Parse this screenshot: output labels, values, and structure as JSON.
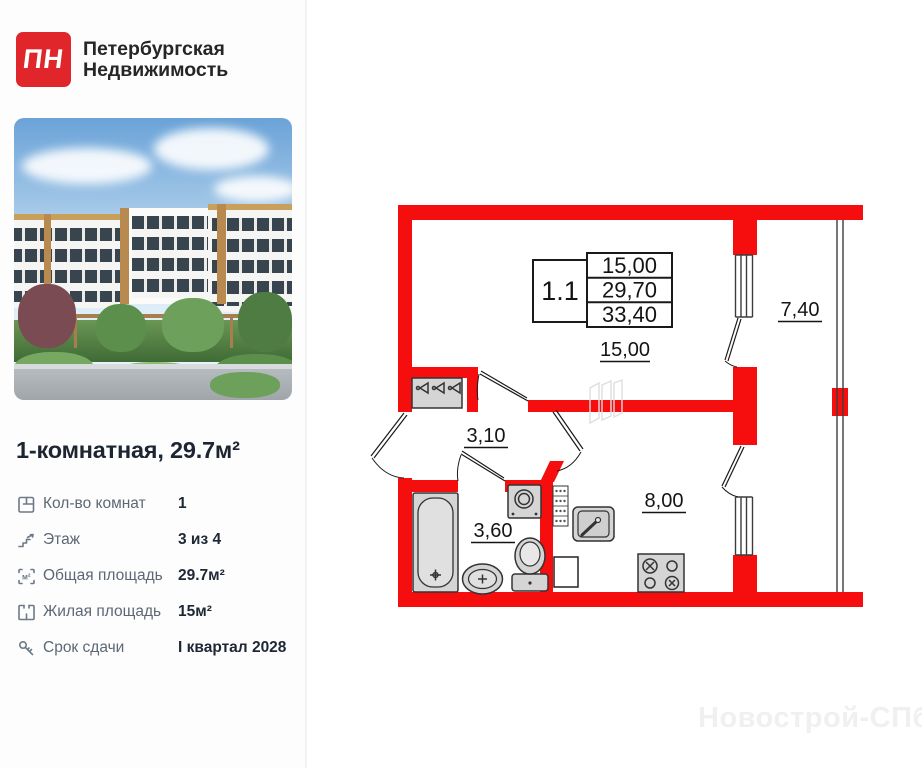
{
  "brand": {
    "logo_text": "ПН",
    "name_line1": "Петербургская",
    "name_line2": "Недвижимость"
  },
  "listing": {
    "title": "1-комнатная, 29.7м²",
    "details": [
      {
        "icon": "room-count-icon",
        "label": "Кол-во комнат",
        "value": "1"
      },
      {
        "icon": "floor-icon",
        "label": "Этаж",
        "value": "3 из 4"
      },
      {
        "icon": "total-area-icon",
        "label": "Общая площадь",
        "value": "29.7м²"
      },
      {
        "icon": "living-area-icon",
        "label": "Жилая площадь",
        "value": "15м²"
      },
      {
        "icon": "key-icon",
        "label": "Срок сдачи",
        "value": "I квартал 2028"
      }
    ]
  },
  "icons": {
    "area_unit": "м²"
  },
  "floor_plan": {
    "unit_number": "1.1",
    "spec_rows": [
      "15,00",
      "29,70",
      "33,40"
    ],
    "rooms": [
      {
        "name": "living-room",
        "area": "15,00"
      },
      {
        "name": "hallway",
        "area": "3,10"
      },
      {
        "name": "bathroom",
        "area": "3,60"
      },
      {
        "name": "kitchen",
        "area": "8,00"
      },
      {
        "name": "balcony",
        "area": "7,40"
      }
    ],
    "colors": {
      "wall": "#f60d0d",
      "fixture_fill": "#d5d5d5",
      "fixture_stroke": "#333333"
    }
  },
  "watermark": "Новострой-СПб"
}
